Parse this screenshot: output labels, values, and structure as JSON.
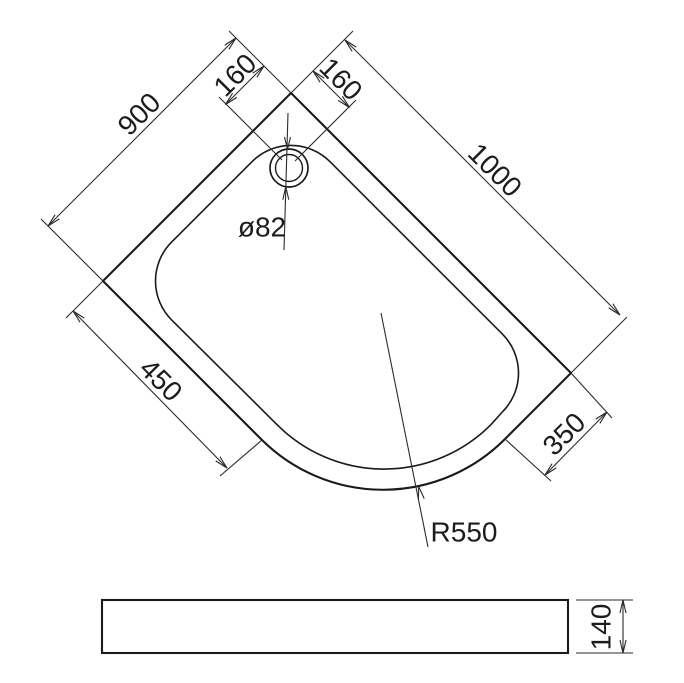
{
  "drawing": {
    "dims": {
      "side_left": "900",
      "side_right": "1000",
      "drain_offset_left": "160",
      "drain_offset_right": "160",
      "front_left": "450",
      "front_right": "350",
      "drain_diameter": "ø82",
      "corner_radius": "R550",
      "tray_height": "140"
    },
    "colors": {
      "line": "#1a1a1a",
      "dimension_line": "#2b2b2b",
      "background": "#ffffff"
    }
  }
}
